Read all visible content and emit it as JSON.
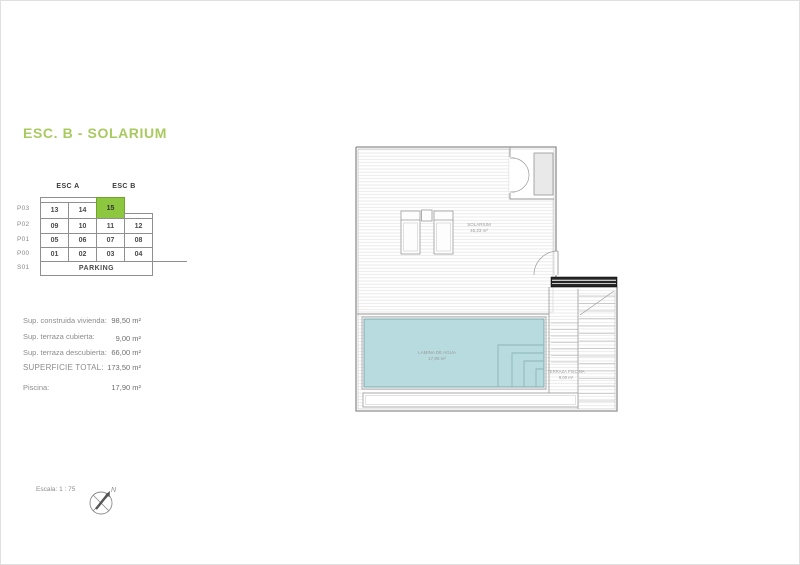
{
  "title": "ESC. B - SOLARIUM",
  "accent_color": "#a9ca5f",
  "unit_table": {
    "col_headers": [
      "ESC A",
      "ESC B"
    ],
    "row_labels": [
      "P03",
      "P02",
      "P01",
      "P00",
      "S01"
    ],
    "floors": [
      {
        "cells": [
          "13",
          "14",
          "15"
        ]
      },
      {
        "cells": [
          "09",
          "10",
          "11",
          "12"
        ]
      },
      {
        "cells": [
          "05",
          "06",
          "07",
          "08"
        ]
      },
      {
        "cells": [
          "01",
          "02",
          "03",
          "04"
        ]
      }
    ],
    "parking_label": "PARKING",
    "highlighted_unit": "15",
    "highlight_color": "#8dc63f"
  },
  "measurements": [
    {
      "label": "Sup. construida vivienda:",
      "value": "98,50 m²"
    },
    {
      "label": "Sup. terraza cubierta:",
      "value": "9,00 m²"
    },
    {
      "label": "Sup. terraza descubierta:",
      "value": "66,00 m²"
    },
    {
      "label": "SUPERFICIE TOTAL:",
      "value": "173,50 m²"
    },
    {
      "label": "Piscina:",
      "value": "17,90 m²"
    }
  ],
  "scale_note": "Escala: 1 : 75",
  "north_label": "N",
  "plan": {
    "solarium": {
      "name": "SOLARIUM",
      "area": "46,23 m²"
    },
    "pool": {
      "name": "LAMINA DE AGUA",
      "area": "17,90 m²",
      "water_color": "#b7dbdf"
    },
    "pool_terrace": {
      "name": "TERRAZA PISCINA",
      "area": "9,00 m²"
    }
  }
}
